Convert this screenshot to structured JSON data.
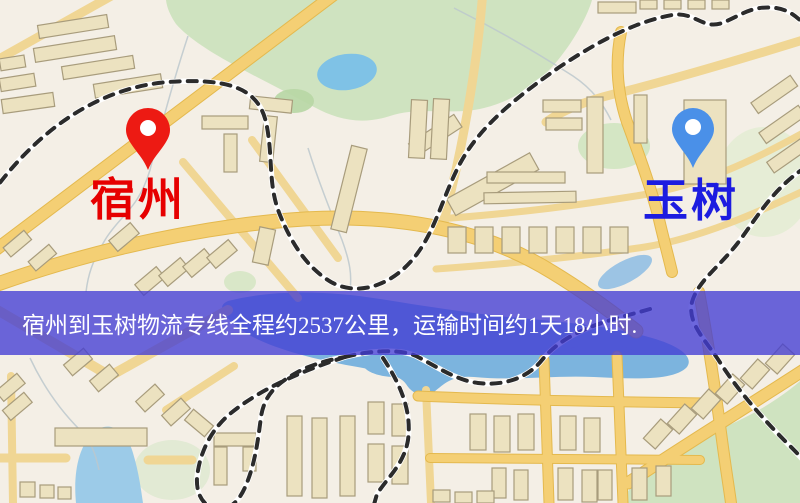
{
  "window": {
    "width": 800,
    "height": 503
  },
  "origin_marker": {
    "city": "宿州",
    "label_color": "#e60000",
    "pin_color": "#ed1a13"
  },
  "destination_marker": {
    "city": "玉树",
    "label_color": "#1c1ce0",
    "pin_color": "#4a90e8"
  },
  "route_banner": {
    "text": "宿州到玉树物流专线全程约2537公里，运输时间约1天18小时.",
    "distance_text": "约2537公里",
    "duration_text": "约1天18小时",
    "background": "rgba(66,60,212,0.78)",
    "text_color": "#ffffff"
  },
  "map_palette": {
    "background": "#f4efe6",
    "road_major": "#f4cf74",
    "road_minor": "#f0d694",
    "building_fill": "#ece2c0",
    "building_outline": "#a89c7c",
    "park_green": "#cfe3c0",
    "water_blue": "#7cb4de",
    "railway_dark": "#2b2b2b"
  }
}
